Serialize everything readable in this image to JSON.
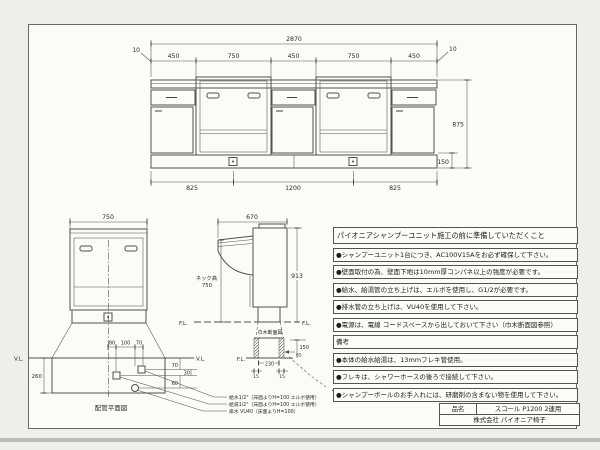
{
  "front_elevation": {
    "dim_overall": "2870",
    "dim_offset_left": "10",
    "dim_offset_right": "10",
    "dim_segments": [
      "450",
      "750",
      "450",
      "750",
      "450"
    ],
    "dim_bottom": [
      "825",
      "1200",
      "825"
    ],
    "dim_height": "875",
    "dim_base": "150"
  },
  "unit_view": {
    "dim_width": "750",
    "vl_left": "V.L.",
    "vl_right": "V.L.",
    "plan": {
      "title": "配管平面図",
      "dim_depth": "260",
      "dims_top": [
        "80",
        "100",
        "70"
      ],
      "dims_right": [
        "70",
        "30",
        "60"
      ]
    },
    "pipes": [
      {
        "label": "給水1/2\"（床面よりH=100 エルボ使用）"
      },
      {
        "label": "給湯1/2\"（床面よりH=100 エルボ使用）"
      },
      {
        "label": "排水 VU40（床面よりH=100）"
      }
    ]
  },
  "side_view": {
    "dim_width": "670",
    "dim_height": "913",
    "neck_label_1": "ネック高",
    "neck_label_2": "750",
    "fl_left": "F.L.",
    "fl_right": "F.L.",
    "fl_detail": "F.L.",
    "detail": {
      "title": "巾木断面図",
      "dim_h": "150",
      "dim_recess": "65",
      "dim_w": "230",
      "dim_m1": "15",
      "dim_m2": "15"
    },
    "cord_note": "・電線、コードスペース"
  },
  "notes": {
    "title": "パイオニアシャンプーユニット施工の前に準備していただくこと",
    "items": [
      "●シャンプーユニット1台につき、AC100V15Aをお必ず確保して下さい。",
      "●壁面取付の為、壁面下地は10mm厚コンパネ以上の強度が必要です。",
      "●給水、給湯管の立ち上げは、エルボを使用し、G1/2が必要です。",
      "●排水管の立ち上げは、VU40を使用して下さい。",
      "●電源は、電線 コードスペースから出しておいて下さい（巾木断面図参照）"
    ],
    "remarks_label": "備考",
    "remarks": [
      "●本体の給水給湯は、13mmフレキ管使用。",
      "●フレキは、シャワーホースの後ろで接続して下さい。",
      "●シャンプーボールのお手入れには、研磨剤の含まない物を使用して下さい。"
    ]
  },
  "title_block": {
    "name_label": "品名",
    "product_name": "スコール  P1200  2連用",
    "company": "株式会社  パイオニア椅子"
  }
}
